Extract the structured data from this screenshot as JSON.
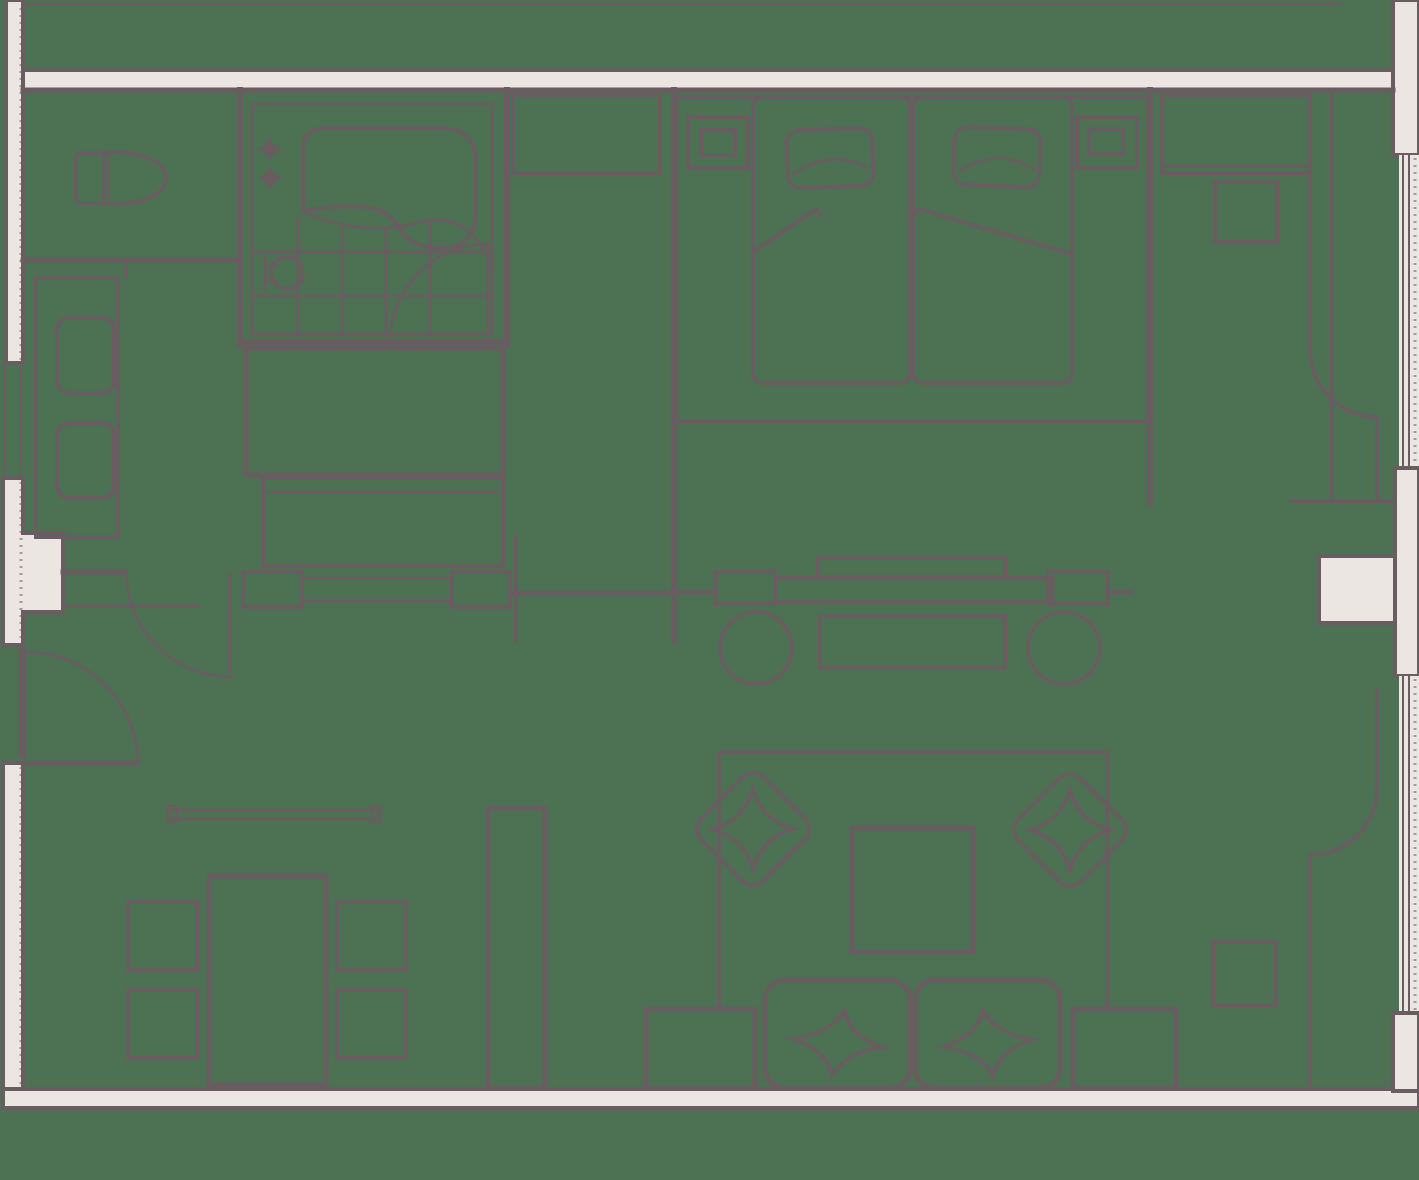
{
  "document": {
    "type": "architectural-floor-plan",
    "subject": "hotel-suite-top-view-floor-plan"
  },
  "colors": {
    "floor": "#4C7253",
    "line": "#695D61",
    "wall_fill": "#EBE6E2"
  },
  "rooms": [
    {
      "name": "wc"
    },
    {
      "name": "bathroom"
    },
    {
      "name": "dressing-area"
    },
    {
      "name": "entry-hall"
    },
    {
      "name": "bedroom"
    },
    {
      "name": "study-nook"
    },
    {
      "name": "living-room"
    },
    {
      "name": "dining-area"
    }
  ],
  "furniture": [
    {
      "name": "toilet"
    },
    {
      "name": "bathtub"
    },
    {
      "name": "faucet-sparkle-icon"
    },
    {
      "name": "shower-head-icon"
    },
    {
      "name": "shower-tile-grid"
    },
    {
      "name": "wardrobe-cabinet"
    },
    {
      "name": "closet-box"
    },
    {
      "name": "luggage-bench"
    },
    {
      "name": "console-dresser"
    },
    {
      "name": "double-bed"
    },
    {
      "name": "mattress"
    },
    {
      "name": "bed-pillow"
    },
    {
      "name": "nightstand"
    },
    {
      "name": "table-lamp"
    },
    {
      "name": "desk"
    },
    {
      "name": "desk-chair"
    },
    {
      "name": "tv-console-divider"
    },
    {
      "name": "tv-screen"
    },
    {
      "name": "stool"
    },
    {
      "name": "divider-table"
    },
    {
      "name": "rug"
    },
    {
      "name": "lounge-chair"
    },
    {
      "name": "star-cushion"
    },
    {
      "name": "coffee-table"
    },
    {
      "name": "sofa"
    },
    {
      "name": "sofa-pillow"
    },
    {
      "name": "side-table"
    },
    {
      "name": "dining-table"
    },
    {
      "name": "dining-chair"
    },
    {
      "name": "tall-cabinet"
    },
    {
      "name": "wall-shelf"
    },
    {
      "name": "door-swing-arc"
    },
    {
      "name": "window"
    },
    {
      "name": "curtain-arc"
    }
  ]
}
